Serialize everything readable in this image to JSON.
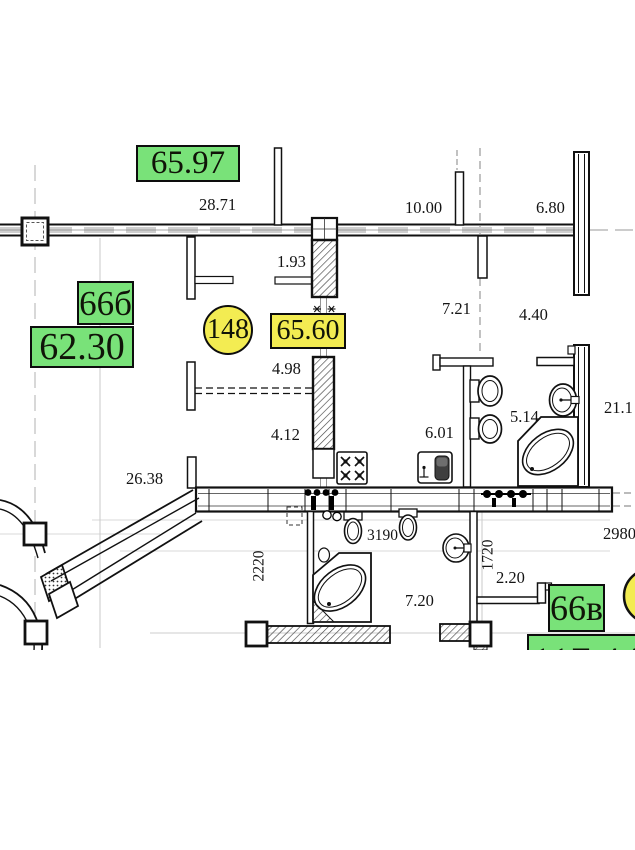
{
  "title": "Floor plan fragment with apartment areas",
  "labels": {
    "apt_area_65_97": "65.97",
    "room_66b": "66б",
    "area_62_30": "62.30",
    "apt_number_148": "148",
    "area_65_60": "65.60",
    "room_66v": "66в",
    "area_117_44": "117.44"
  },
  "dims": {
    "w28_71": "28.71",
    "w10_00": "10.00",
    "w6_80": "6.80",
    "w1_93": "1.93",
    "w7_21": "7.21",
    "w4_40": "4.40",
    "w4_98": "4.98",
    "w4_12": "4.12",
    "w5_14": "5.14",
    "w6_01": "6.01",
    "w21_1": "21.1",
    "w26_38": "26.38",
    "w3190": "3190",
    "w2220": "2220",
    "w1720": "1720",
    "w2_20": "2.20",
    "w7_20": "7.20",
    "w2980": "2980"
  },
  "colors": {
    "area_label_green": "#79e279",
    "marker_yellow": "#f3ec52",
    "line_black": "#111111"
  }
}
